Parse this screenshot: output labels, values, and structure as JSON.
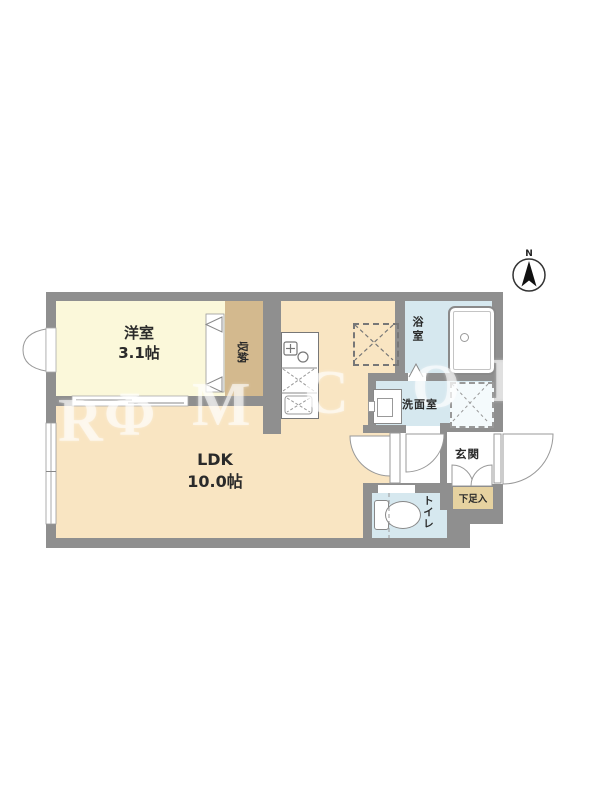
{
  "compass": {
    "north_label": "N"
  },
  "watermark": {
    "letters": [
      "R",
      "Φ",
      "M",
      "C",
      "O",
      "D"
    ]
  },
  "rooms": {
    "bedroom": {
      "name": "洋室",
      "size": "3.1帖"
    },
    "ldk": {
      "name": "LDK",
      "size": "10.0帖"
    },
    "closet": {
      "label": "収納"
    },
    "bath": {
      "label": "浴室"
    },
    "washroom": {
      "label": "洗面室"
    },
    "entrance": {
      "label": "玄関"
    },
    "shoe_cabinet": {
      "label": "下足入"
    },
    "toilet": {
      "label": "トイレ"
    }
  },
  "colors": {
    "wall": "#8f8f8f",
    "bedroom_floor": "#fbf8da",
    "ldk_floor": "#f9e5c2",
    "closet_floor": "#d3b98e",
    "wet_area_floor": "#d6e8ef",
    "shoe_cabinet_fill": "#e6d2a0"
  }
}
